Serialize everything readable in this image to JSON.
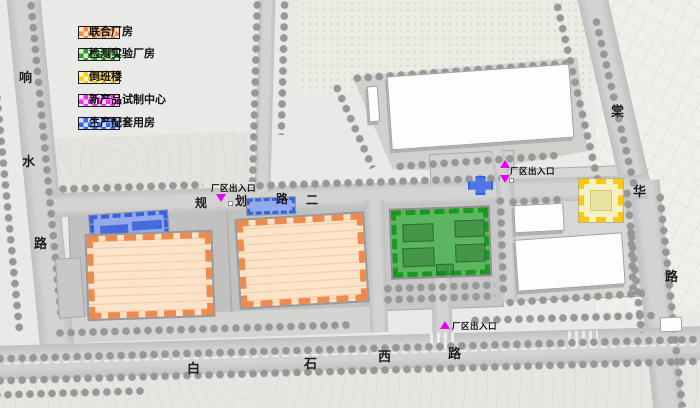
{
  "legend": {
    "items": [
      {
        "label": "联合厂房",
        "dot": "#ef8a4c",
        "bg": "#fbe2c4"
      },
      {
        "label": "检测实验厂房",
        "dot": "#2f9e2f",
        "bg": "#d7ecd2"
      },
      {
        "label": "倒班楼",
        "dot": "#ffc80a",
        "bg": "#faf3cd"
      },
      {
        "label": "新产品试制中心",
        "dot": "#f02cf0",
        "bg": "#fadcf5"
      },
      {
        "label": "生产配套用房",
        "dot": "#3a66e6",
        "bg": "#ccd9f6"
      }
    ]
  },
  "roads": {
    "xiangshui": {
      "name": "响水路",
      "chars": [
        "响",
        "水",
        "路"
      ]
    },
    "tanghua": {
      "name": "棠华路",
      "chars": [
        "棠",
        "华",
        "路"
      ]
    },
    "baishixi": {
      "name": "白石西路",
      "chars": [
        "白",
        "石",
        "西",
        "路"
      ]
    },
    "guihua": {
      "name": "规划路二",
      "chars": [
        "规",
        "划",
        "路",
        "二"
      ]
    }
  },
  "markers": {
    "entrance_label": "厂区出入口"
  },
  "colors": {
    "orange-dot": "#ef8a4c",
    "orange-fill": "#fbe3c9",
    "green-dot": "#189a1e",
    "green-fill": "#5cb55f",
    "yellow-dot": "#fdc70d",
    "yellow-fill": "#f5f1c2",
    "yellow-inner": "#e9e3a0",
    "blue-dot": "#3561e2",
    "blue-fill": "#93abec",
    "blue-inner": "#3a5fd8",
    "magenta": "#ea00ea",
    "road": "#c9c9c9",
    "ground": "#e9e9e7",
    "pad": "#c2c2c2",
    "tree": "#979797"
  }
}
